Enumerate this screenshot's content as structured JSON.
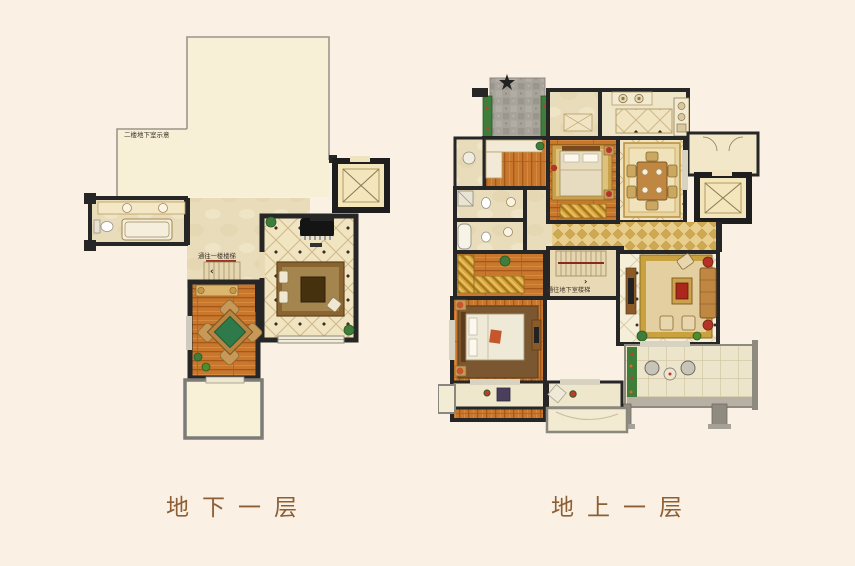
{
  "page": {
    "background": "#faf0e3"
  },
  "captions": {
    "basement": "地下一层",
    "ground": "地上一层"
  },
  "labels": {
    "basement_projection": "二楼地下室示意",
    "basement_stairs": "通往一楼楼梯",
    "basement_stairs_arrow": "‹",
    "ground_stairs": "通往地下室楼梯",
    "ground_stairs_arrow": "›"
  },
  "palette": {
    "background": "#faf0e3",
    "caption_text": "#8d5f35",
    "label_text": "#3b332a",
    "wall": "#262626",
    "wood_floor": "#c9772c",
    "tile_floor": "#f1e4c1",
    "marble_floor": "#e9dcba",
    "gold_hall": "#e8cf8e",
    "rug_brown": "#8a6430",
    "table_green": "#2f7a4b",
    "accent_red": "#b33426",
    "plant_green": "#3f7d3a",
    "stone_path": "#a7a29a",
    "projection_outline": "#9b968c"
  }
}
